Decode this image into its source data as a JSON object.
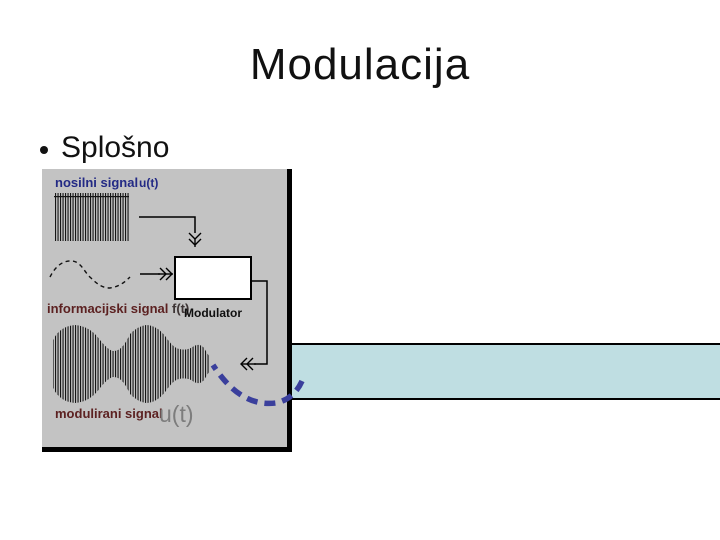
{
  "slide": {
    "title": "Modulacija",
    "bullet": "Splošno"
  },
  "diagram": {
    "labels": {
      "carrier": "nosilni signal",
      "carrier_symbol": "u(t)",
      "info": "informacijski signal",
      "info_symbol": "f(t)",
      "modulator": "Modulator",
      "modulated": "modulirani signal",
      "modulated_symbol": "u(t)"
    },
    "colors": {
      "panel_bg": "#c3c3c3",
      "teal_bar": "#bfdee2",
      "navy_label": "#232a85",
      "maroon_label": "#5c2121",
      "symbol_dark": "#3d3434",
      "gray_symbol": "#7d7d7d",
      "dashed_arrow": "#3a3f9c",
      "line": "#000000"
    }
  }
}
